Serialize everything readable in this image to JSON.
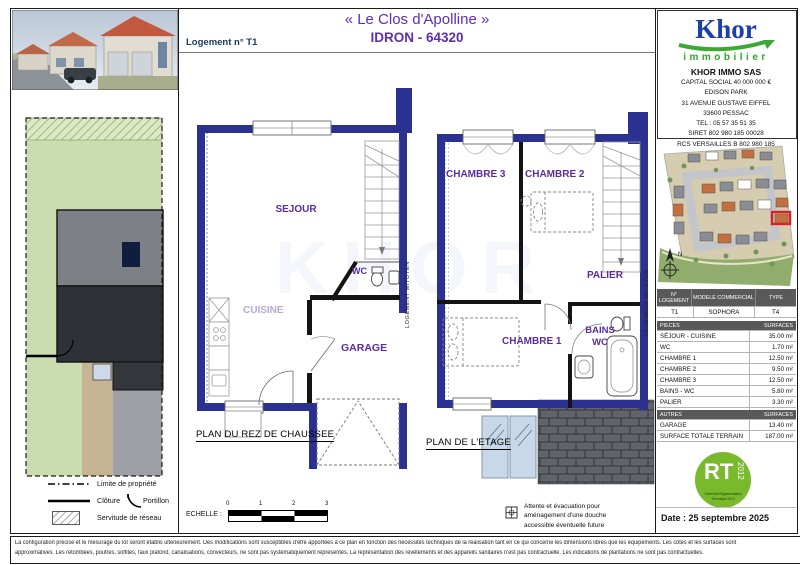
{
  "header": {
    "title": "« Le Clos d'Apolline »",
    "subtitle": "IDRON - 64320",
    "lot_label": "Logement n° T1"
  },
  "watermark": {
    "text": "KHOR"
  },
  "company": {
    "logo_text": "Khor",
    "logo_subtext": "immobilier",
    "name": "KHOR IMMO SAS",
    "address_lines": [
      "CAPITAL SOCIAL 40 000 000 €",
      "EDISON PARK",
      "31 AVENUE GUSTAVE EIFFEL",
      "33600 PESSAC",
      "TEL : 05 57 35 51 35",
      "SIRET 802 980 185 00028",
      "RCS VERSAILLES B 802 980 185"
    ]
  },
  "site_plan": {
    "compass_label": "N"
  },
  "plans": {
    "rdc": {
      "caption": "PLAN DU REZ DE CHAUSSEE",
      "rooms": {
        "sejour": "SEJOUR",
        "cuisine": "CUISINE",
        "garage": "GARAGE",
        "wc": "WC"
      },
      "party_wall_label": "LOGEMENT MITOYEN"
    },
    "etage": {
      "caption": "PLAN DE L'ETAGE",
      "rooms": {
        "chambre3": "CHAMBRE 3",
        "chambre2": "CHAMBRE 2",
        "chambre1": "CHAMBRE 1",
        "bains_line1": "BAINS",
        "bains_line2": "WC",
        "palier": "PALIER"
      },
      "party_wall_label": "LOGEMENT MITOYEN"
    }
  },
  "plot_legend": {
    "limite": "Limite de propriété",
    "cloture": "Clôture",
    "portillon": "Portillon",
    "servitude": "Servitude de réseau"
  },
  "scale": {
    "label": "ECHELLE :",
    "ticks": [
      "0",
      "1",
      "2",
      "3"
    ]
  },
  "shower_note": {
    "lines": [
      "Attente et évacuation pour",
      "aménagement d'une douche",
      "accessible éventuelle future"
    ]
  },
  "unit_table": {
    "headers": [
      "N° LOGEMENT",
      "MODELE COMMERCIAL",
      "TYPE"
    ],
    "row": [
      "T1",
      "SOPHORA",
      "T4"
    ]
  },
  "pieces_table": {
    "headers": [
      "PIECES",
      "SURFACES"
    ],
    "rows": [
      [
        "SÉJOUR - CUISINE",
        "35.00 m²"
      ],
      [
        "WC",
        "1.70 m²"
      ],
      [
        "CHAMBRE 1",
        "12.50 m²"
      ],
      [
        "CHAMBRE 2",
        "9.50 m²"
      ],
      [
        "CHAMBRE 3",
        "12.50 m²"
      ],
      [
        "BAINS - WC",
        "5.80 m²"
      ],
      [
        "PALIER",
        "3.30 m²"
      ]
    ],
    "total_label": "TOTAL",
    "total_value": "80.30 m²"
  },
  "autres_table": {
    "headers": [
      "AUTRES",
      "SURFACES"
    ],
    "rows": [
      [
        "GARAGE",
        "13.40 m²"
      ],
      [
        "SURFACE TOTALE TERRAIN",
        "187.00 m²"
      ]
    ]
  },
  "rt_badge": {
    "main": "RT",
    "year": "2012",
    "sub1": "Conforme Réglementation",
    "sub2": "Thermique 2012"
  },
  "date_line": "Date : 25 septembre 2025",
  "disclaimer": {
    "line1": "La configuration précise et le mesurage du lot seront établis ultérieurement. Des modifications sont susceptibles d'être apportées à ce plan en fonction des nécessités techniques de la réalisation tant en ce qui concerne les dimensions libres que les équipements. Les côtes et les surfaces sont",
    "line2": "approximatives. Les retombées, poutres, soffites, faux plafond, canalisations, convecteurs, ne sont pas systématiquement représentés. La représentation des revêtements et des appareils sanitaires n'est pas contractuelle. Les indications de plantations ne sont pas contractuelles."
  }
}
